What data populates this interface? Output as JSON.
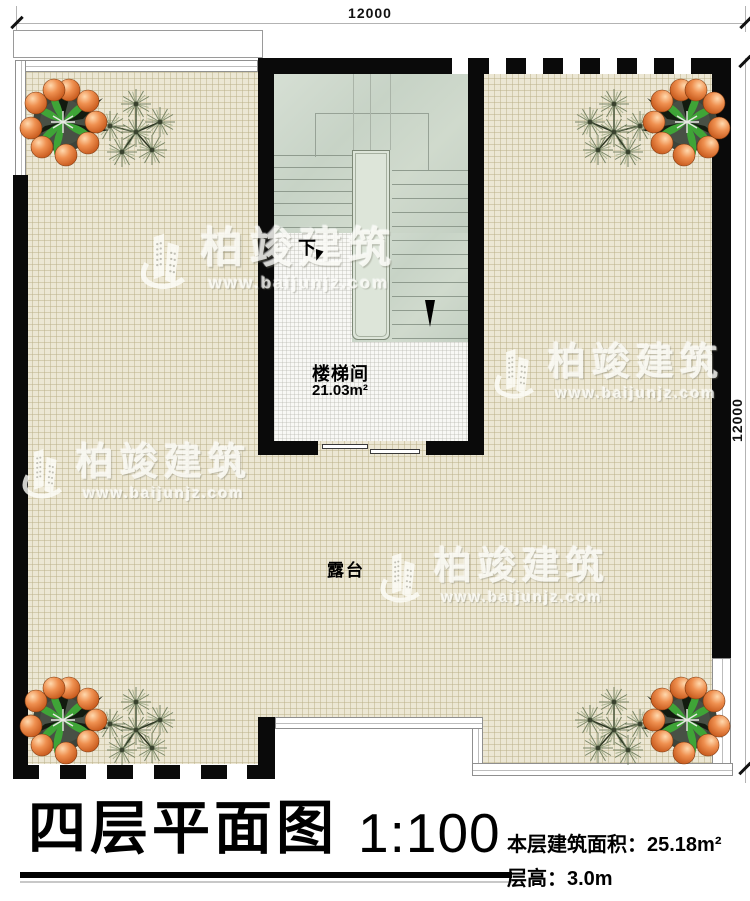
{
  "drawing": {
    "dimensions": {
      "top_width": "12000",
      "right_height": "12000"
    },
    "stairwell": {
      "label": "楼梯间",
      "area": "21.03m²",
      "direction": "下"
    },
    "terrace": {
      "label": "露台"
    },
    "title_block": {
      "title": "四层平面图",
      "scale": "1:100",
      "floor_area": "本层建筑面积：25.18m²",
      "floor_height": "层高：3.0m"
    },
    "watermark": {
      "brand": "柏竣建筑",
      "url": "www.baijunjz.com"
    },
    "colors": {
      "wall": "#0a0a0a",
      "terrace_floor": "#ece7d4",
      "stair_fill": "#cbd5c8",
      "tile_floor": "#f8f8f5"
    }
  }
}
